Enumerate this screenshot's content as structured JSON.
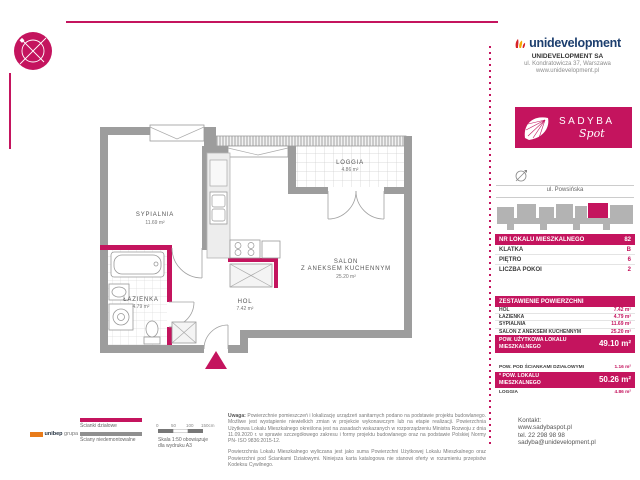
{
  "brand": {
    "magenta": "#c4145e",
    "navy": "#1c3e6e",
    "orange": "#e87b1a",
    "wall_gray": "#9d9d9d"
  },
  "header": {
    "developer_logo": "unidevelopment",
    "developer_name": "UNIDEVELOPMENT SA",
    "developer_address": "ul. Kondratowicza 37, Warszawa",
    "developer_website": "www.unidevelopment.pl"
  },
  "project": {
    "name": "SADYBA",
    "sub": "Spot"
  },
  "location": {
    "street": "ul. Powsińska"
  },
  "unit_table": {
    "header_label": "NR LOKALU MIESZKALNEGO",
    "header_value": "82",
    "rows": [
      {
        "label": "KLATKA",
        "value": "B"
      },
      {
        "label": "PIĘTRO",
        "value": "6"
      },
      {
        "label": "LICZBA POKOI",
        "value": "2"
      }
    ]
  },
  "area_table": {
    "title": "ZESTAWIENIE POWIERZCHNI",
    "rows": [
      {
        "label": "HOL",
        "value": "7.42 m²"
      },
      {
        "label": "ŁAZIENKA",
        "value": "4.79 m²"
      },
      {
        "label": "SYPIALNIA",
        "value": "11.69 m²"
      },
      {
        "label": "SALON Z ANEKSEM KUCHENNYM",
        "value": "25.20 m²"
      }
    ],
    "usable": {
      "label": "POW. UŻYTKOWA LOKALU MIESZKALNEGO",
      "value": "49.10 m²"
    },
    "partitions": {
      "label": "POW. POD ŚCIANKAMI DZIAŁOWYMI",
      "value": "1.16 m²"
    },
    "total": {
      "label": "* POW. LOKALU MIESZKALNEGO",
      "value": "50.26 m²"
    },
    "loggia": {
      "label": "LOGGIA",
      "value": "4.86 m²"
    }
  },
  "plan": {
    "rooms": {
      "sypialnia": {
        "name": "SYPIALNIA",
        "area": "11.69 m²"
      },
      "lazienka": {
        "name": "ŁAZIENKA",
        "area": "4.79 m²"
      },
      "hol": {
        "name": "HOL",
        "area": "7.42 m²"
      },
      "salon": {
        "name": "SALON",
        "name2": "Z ANEKSEM KUCHENNYM",
        "area": "25.20 m²"
      },
      "loggia": {
        "name": "LOGGIA",
        "area": "4.86 m²"
      }
    }
  },
  "legend": {
    "partition_label": "Ścianki działowe",
    "structural_label": "Ściany niedemontowalne"
  },
  "scale": {
    "ticks": [
      "0",
      "50",
      "100",
      "150cm"
    ],
    "note_line1": "Skala 1:50 obowiązuje",
    "note_line2": "dla wydruku A3"
  },
  "group_logo": {
    "bold": "unibep",
    "light": "grupa"
  },
  "disclaimer": {
    "label": "Uwaga:",
    "p1": "Powierzchnie pomieszczeń i lokalizację urządzeń sanitarnych podano na podstawie projektu budowlanego. Możliwe jest wystąpienie niewielkich zmian w projekcie wykonawczym lub na etapie realizacji. Powierzchnia Użytkowa Lokalu Mieszkalnego określona jest na zasadach wskazanych w rozporządzeniu Ministra Rozwoju z dnia 11.09.2020 r. w sprawie szczegółowego zakresu i formy projektu budowlanego oraz na podstawie Polskiej Normy PN- ISO 9836:2015-12.",
    "p2": "Powierzchnia Lokalu Mieszkalnego wyliczana jest jako suma Powierzchni Użytkowej Lokalu Mieszkalnego oraz Powierzchni pod Ściankami Działowymi. Niniejsza karta katalogowa nie stanowi oferty w rozumieniu przepisów Kodeksu Cywilnego."
  },
  "contact": {
    "heading": "Kontakt:",
    "website": "www.sadybaspot.pl",
    "phone": "tel. 22 298 98 98",
    "email": "sadyba@unidevelopment.pl"
  }
}
